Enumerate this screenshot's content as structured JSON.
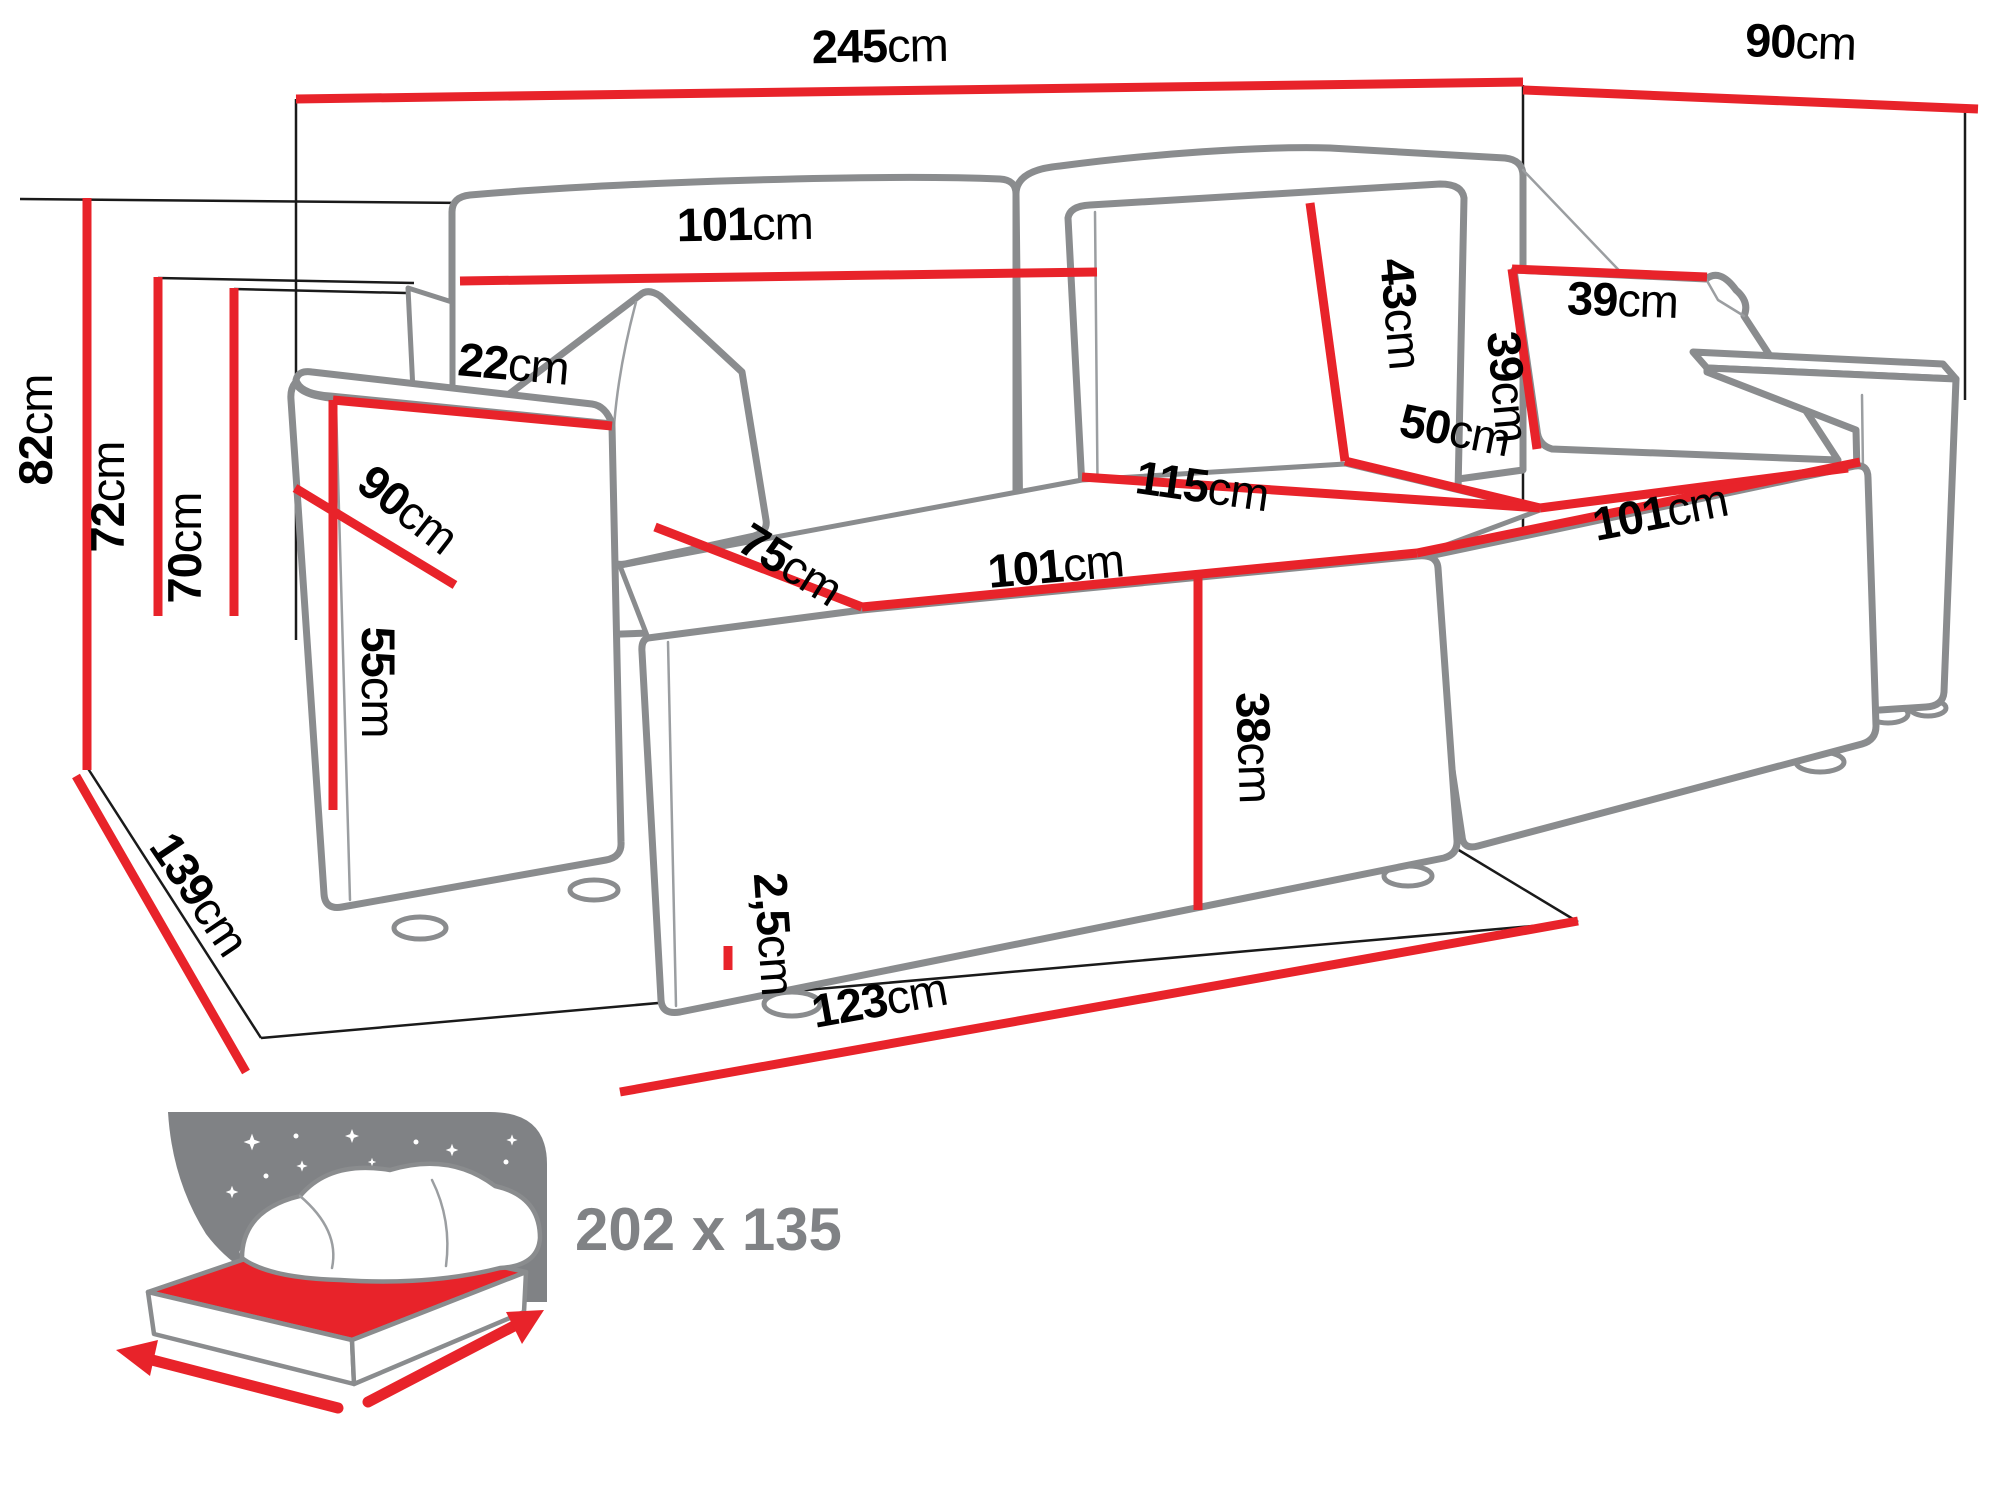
{
  "labels": {
    "overall_width": {
      "v": "245",
      "u": "cm"
    },
    "overall_depth": {
      "v": "90",
      "u": "cm"
    },
    "height_total": {
      "v": "82",
      "u": "cm"
    },
    "height_backrest": {
      "v": "72",
      "u": "cm"
    },
    "height_seat_back": {
      "v": "70",
      "u": "cm"
    },
    "backrest_width": {
      "v": "101",
      "u": "cm"
    },
    "armrest_top_width": {
      "v": "22",
      "u": "cm"
    },
    "armrest_depth": {
      "v": "90",
      "u": "cm"
    },
    "armrest_height": {
      "v": "55",
      "u": "cm"
    },
    "back_cushion_height": {
      "v": "43",
      "u": "cm"
    },
    "pillow_width": {
      "v": "39",
      "u": "cm"
    },
    "pillow_height": {
      "v": "39",
      "u": "cm"
    },
    "corner_seat_width": {
      "v": "115",
      "u": "cm"
    },
    "corner_seat_depth": {
      "v": "50",
      "u": "cm"
    },
    "seat_depth": {
      "v": "75",
      "u": "cm"
    },
    "seat_front_width": {
      "v": "101",
      "u": "cm"
    },
    "chaise_length": {
      "v": "101",
      "u": "cm"
    },
    "seat_height": {
      "v": "38",
      "u": "cm"
    },
    "leg_height": {
      "v": "2,5",
      "u": "cm"
    },
    "front_floor_width": {
      "v": "123",
      "u": "cm"
    },
    "side_floor_depth": {
      "v": "139",
      "u": "cm"
    }
  },
  "sleeping_area": {
    "value": "202 x 135"
  },
  "colors": {
    "dimension_red": "#e8232a",
    "outline_gray": "#8a8c8e",
    "label_black": "#000000",
    "icon_gray": "#808285"
  }
}
